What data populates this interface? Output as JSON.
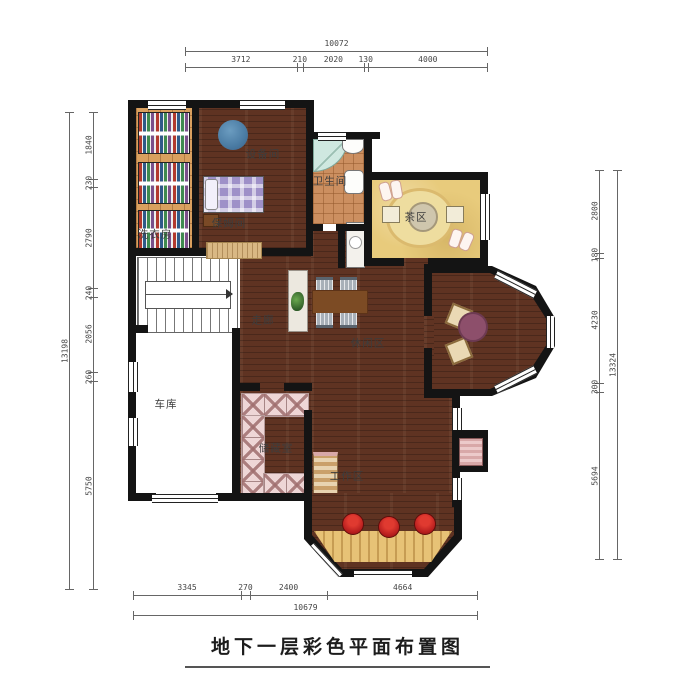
{
  "title": {
    "text": "地下一层彩色平面布置图"
  },
  "rooms": {
    "laundry": {
      "label": "洗衣房"
    },
    "equipment": {
      "label": "设备间"
    },
    "bathroom": {
      "label": "卫生间"
    },
    "tea": {
      "label": "茶区"
    },
    "nanny": {
      "label": "保姆间"
    },
    "corridor": {
      "label": "走廊"
    },
    "leisure": {
      "label": "休闲区"
    },
    "garage": {
      "label": "车库"
    },
    "storage": {
      "label": "储藏室"
    },
    "work": {
      "label": "工作区"
    }
  },
  "dimensions": {
    "top": {
      "total": "10072",
      "segments": [
        "3712",
        "210",
        "2020",
        "130",
        "4000"
      ]
    },
    "bottom": {
      "total": "10679",
      "segments": [
        "3345",
        "270",
        "2400",
        "4664"
      ]
    },
    "left": {
      "total": "13198",
      "segments": [
        "1840",
        "230",
        "2790",
        "240",
        "2056",
        "260",
        "5750"
      ]
    },
    "right": {
      "total": "13324",
      "segments": [
        "2800",
        "180",
        "4230",
        "300",
        "5694"
      ]
    }
  },
  "icons": {
    "water_tank": "blue-circle-equipment-tank",
    "stair_arrow": "stair-direction-arrow",
    "plant": "potted-plant"
  },
  "colors": {
    "wall": "#141414",
    "dark_wood_floor": "#5f3322",
    "laundry_tile": "#d9a05f",
    "bath_tile": "#cc8f60",
    "tea_floor": "#e8cb7c",
    "storage_shelf_pink": "#eed6d6",
    "stool_red": "#b51d1d",
    "tank_blue": "#4a7ba3",
    "bed_purple": "#9e90c8",
    "bay_table_purple": "#8d4f6b",
    "counter_tan": "#e7c276"
  }
}
